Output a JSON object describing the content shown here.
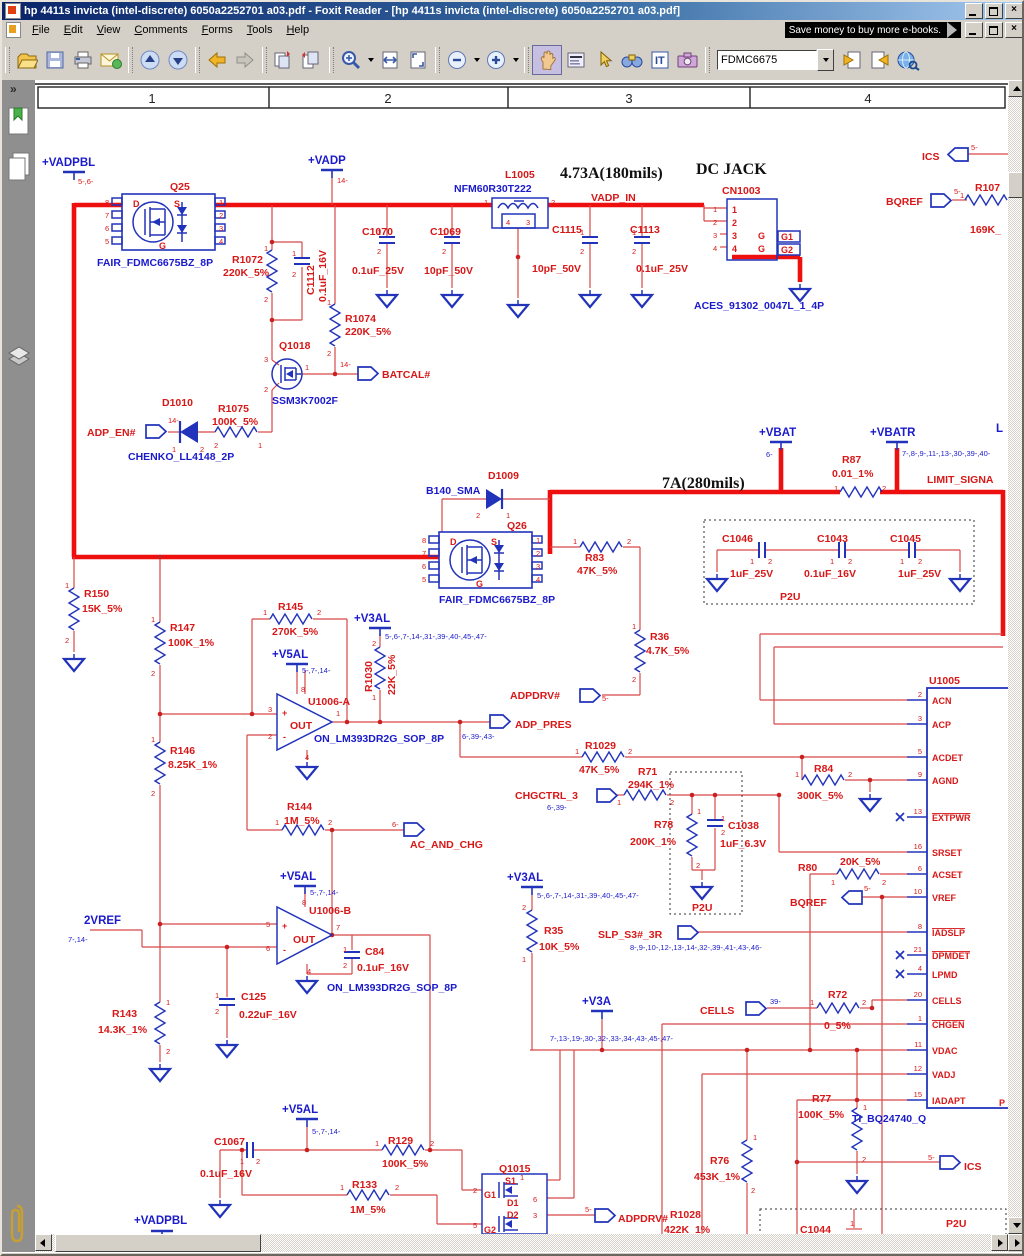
{
  "window": {
    "title": "hp 4411s invicta (intel-discrete) 6050a2252701 a03.pdf - Foxit Reader - [hp 4411s invicta (intel-discrete) 6050a2252701 a03.pdf]",
    "menus": [
      "File",
      "Edit",
      "View",
      "Comments",
      "Forms",
      "Tools",
      "Help"
    ],
    "ad_banner": "Save money to buy more e-books.",
    "search_value": "FDMC6675"
  },
  "colors": {
    "chrome": "#d4d0c8",
    "title_from": "#0a246a",
    "title_to": "#a6caf0",
    "bus_red": "#ee0f0f",
    "wire_red": "#d84848",
    "symbol_blue": "#2233bb",
    "label_red": "#d81818",
    "part_blue": "#1a1acc"
  },
  "ruler": {
    "cols": [
      "1",
      "2",
      "3",
      "4"
    ]
  },
  "pins": {
    "n1": "1",
    "n2": "2",
    "n3": "3",
    "n4": "4",
    "n5": "5",
    "n6": "6",
    "n7": "7",
    "n8": "8",
    "d": "D",
    "s": "S",
    "g": "G",
    "g1": "G1",
    "g2": "G2",
    "s1": "S1",
    "d1": "D1",
    "d2": "D2",
    "plus": "+",
    "minus": "-",
    "out": "OUT"
  },
  "ann": {
    "dc_jack": "DC JACK",
    "amp1": "4.73A(180mils)",
    "amp2": "7A(280mils)",
    "vadp_in": "VADP_IN",
    "limit": "LIMIT_SIGNA",
    "p2u": "P2U",
    "l_partial": "L",
    "p_partial": "P"
  },
  "nets": {
    "vadpbl": "+VADPBL",
    "vadpbl_ref": "5-,6-",
    "vadp": "+VADP",
    "vadp_ref": "14-",
    "v5al": "+V5AL",
    "v5al_ref": "5-,7-,14-",
    "v3al": "+V3AL",
    "v3al_ref": "5-,6-,7-,14-,31-,39-,40-,45-,47-",
    "vbat": "+VBAT",
    "vbat_ref": "6-",
    "vbatr": "+VBATR",
    "vbatr_ref": "7-,8-,9-,11-,13-,30-,39-,40-",
    "v3a": "+V3A",
    "v3a_ref": "7-,13-,19-,30-,32-,33-,34-,43-,45-,47-",
    "vref2": "2VREF",
    "vref2_ref": "7-,14-"
  },
  "ports": {
    "adp_en": "ADP_EN#",
    "adp_en_ref": "14-",
    "batcal": "BATCAL#",
    "batcal_ref": "14-",
    "adpdrv": "ADPDRV#",
    "adpdrv_ref": "5-",
    "adp_pres": "ADP_PRES",
    "adp_pres_ref": "6-,39-,43-",
    "chgctrl": "CHGCTRL_3",
    "chgctrl_ref": "6-,39-",
    "ac_and_chg": "AC_AND_CHG",
    "ac_and_chg_ref": "6-",
    "slp_s3": "SLP_S3#_3R",
    "slp_s3_ref": "8-,9-,10-,12-,13-,14-,32-,39-,41-,43-,46-",
    "cells": "CELLS",
    "cells_ref": "39-",
    "bqref": "BQREF",
    "bqref_ref": "5-",
    "ics": "ICS",
    "ics_ref": "5-"
  },
  "comp": {
    "q25": {
      "ref": "Q25",
      "part": "FAIR_FDMC6675BZ_8P"
    },
    "q26": {
      "ref": "Q26",
      "part": "FAIR_FDMC6675BZ_8P"
    },
    "q1018": {
      "ref": "Q1018",
      "part": "SSM3K7002F"
    },
    "q1015": {
      "ref": "Q1015"
    },
    "d1010": {
      "ref": "D1010",
      "part": "CHENKO_LL4148_2P"
    },
    "d1009": {
      "ref": "D1009",
      "part": "B140_SMA"
    },
    "l1005": {
      "ref": "L1005",
      "part": "NFM60R30T222"
    },
    "cn1003": {
      "ref": "CN1003",
      "part": "ACES_91302_0047L_1_4P"
    },
    "u1006a": {
      "ref": "U1006-A",
      "part": "ON_LM393DR2G_SOP_8P"
    },
    "u1006b": {
      "ref": "U1006-B",
      "part": "ON_LM393DR2G_SOP_8P"
    },
    "u1005": {
      "ref": "U1005",
      "part": "TI_BQ24740_Q"
    },
    "r1072": {
      "ref": "R1072",
      "val": "220K_5%"
    },
    "r1074": {
      "ref": "R1074",
      "val": "220K_5%"
    },
    "r1075": {
      "ref": "R1075",
      "val": "100K_5%"
    },
    "r107": {
      "ref": "R107",
      "val": "169K_"
    },
    "r150": {
      "ref": "R150",
      "val": "15K_5%"
    },
    "r147": {
      "ref": "R147",
      "val": "100K_1%"
    },
    "r146": {
      "ref": "R146",
      "val": "8.25K_1%"
    },
    "r145": {
      "ref": "R145",
      "val": "270K_5%"
    },
    "r144": {
      "ref": "R144",
      "val": "1M_5%"
    },
    "r143": {
      "ref": "R143",
      "val": "14.3K_1%"
    },
    "r1030": {
      "ref": "R1030",
      "val": "22K_5%"
    },
    "r1029": {
      "ref": "R1029",
      "val": "47K_5%"
    },
    "r83": {
      "ref": "R83",
      "val": "47K_5%"
    },
    "r36": {
      "ref": "R36",
      "val": "4.7K_5%"
    },
    "r87": {
      "ref": "R87",
      "val": "0.01_1%"
    },
    "r71": {
      "ref": "R71",
      "val": "294K_1%"
    },
    "r78": {
      "ref": "R78",
      "val": "200K_1%"
    },
    "r84": {
      "ref": "R84",
      "val": "300K_5%"
    },
    "r80": {
      "ref": "R80",
      "val": "20K_5%"
    },
    "r35": {
      "ref": "R35",
      "val": "10K_5%"
    },
    "r72": {
      "ref": "R72",
      "val": "0_5%"
    },
    "r77": {
      "ref": "R77",
      "val": "100K_5%"
    },
    "r76": {
      "ref": "R76",
      "val": "453K_1%"
    },
    "r129": {
      "ref": "R129",
      "val": "100K_5%"
    },
    "r133": {
      "ref": "R133",
      "val": "1M_5%"
    },
    "r1028": {
      "ref": "R1028",
      "val": "422K_1%"
    },
    "c1112": {
      "ref": "C1112",
      "val": "0.1uF_16V"
    },
    "c1070": {
      "ref": "C1070",
      "val": "0.1uF_25V"
    },
    "c1069": {
      "ref": "C1069",
      "val": "10pF_50V"
    },
    "c1115": {
      "ref": "C1115",
      "val": "10pF_50V"
    },
    "c1113": {
      "ref": "C1113",
      "val": "0.1uF_25V"
    },
    "c1046": {
      "ref": "C1046",
      "val": "1uF_25V"
    },
    "c1043": {
      "ref": "C1043",
      "val": "0.1uF_16V"
    },
    "c1045": {
      "ref": "C1045",
      "val": "1uF_25V"
    },
    "c1038": {
      "ref": "C1038",
      "val": "1uF_6.3V"
    },
    "c84": {
      "ref": "C84",
      "val": "0.1uF_16V"
    },
    "c125": {
      "ref": "C125",
      "val": "0.22uF_16V"
    },
    "c1067": {
      "ref": "C1067",
      "val": "0.1uF_16V"
    },
    "c1044": {
      "ref": "C1044"
    }
  },
  "u1005_pins": [
    {
      "num": "2",
      "name": "ACN"
    },
    {
      "num": "3",
      "name": "ACP"
    },
    {
      "num": "5",
      "name": "ACDET"
    },
    {
      "num": "9",
      "name": "AGND"
    },
    {
      "num": "13",
      "name": "EXTPWR"
    },
    {
      "num": "16",
      "name": "SRSET"
    },
    {
      "num": "6",
      "name": "ACSET"
    },
    {
      "num": "10",
      "name": "VREF"
    },
    {
      "num": "8",
      "name": "IADSLP"
    },
    {
      "num": "21",
      "name": "DPMDET"
    },
    {
      "num": "4",
      "name": "LPMD"
    },
    {
      "num": "20",
      "name": "CELLS"
    },
    {
      "num": "1",
      "name": "CHGEN"
    },
    {
      "num": "11",
      "name": "VDAC"
    },
    {
      "num": "12",
      "name": "VADJ"
    },
    {
      "num": "15",
      "name": "IADAPT"
    }
  ]
}
